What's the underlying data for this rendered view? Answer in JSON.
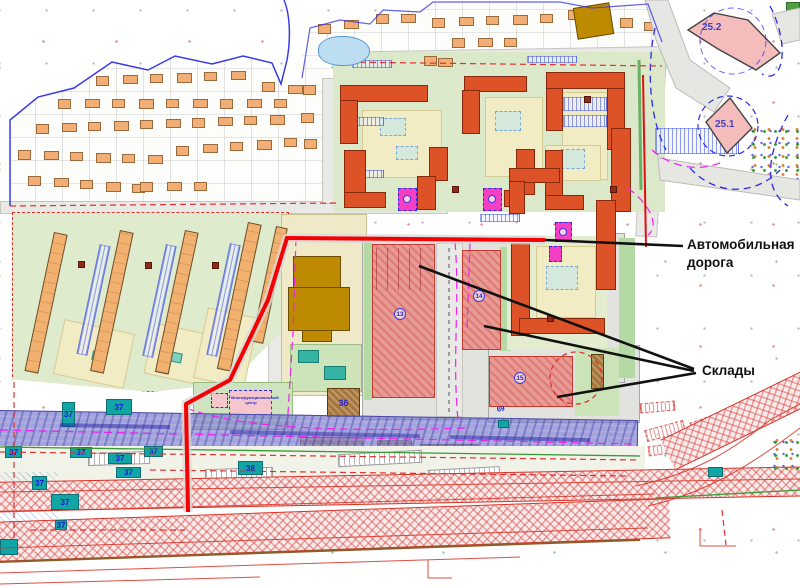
{
  "annotations": {
    "road_label": "Автомобильная дорога",
    "warehouses_label": "Склады"
  },
  "zones": {
    "zone_25_2": "25.2",
    "zone_25_1": "25.1"
  },
  "plots": {
    "plot_37": "37",
    "plot_38": "38",
    "building_36": "36"
  },
  "markers": {
    "warehouse_1": "13",
    "warehouse_2": "14",
    "warehouse_3": "15",
    "road_point": "69",
    "mfc_label": "Многофункциональный центр"
  },
  "colors": {
    "apartment_building": "#DD5226",
    "individual_house": "#F2AE74",
    "warehouse_fill": "#E89A94",
    "teal_building": "#12A5A5",
    "brown_building": "#A6763B",
    "pink_zone": "#F5BCBC",
    "utility_band": "#8080D0",
    "highlight_road": "#F50000",
    "annotation": "#111111"
  }
}
